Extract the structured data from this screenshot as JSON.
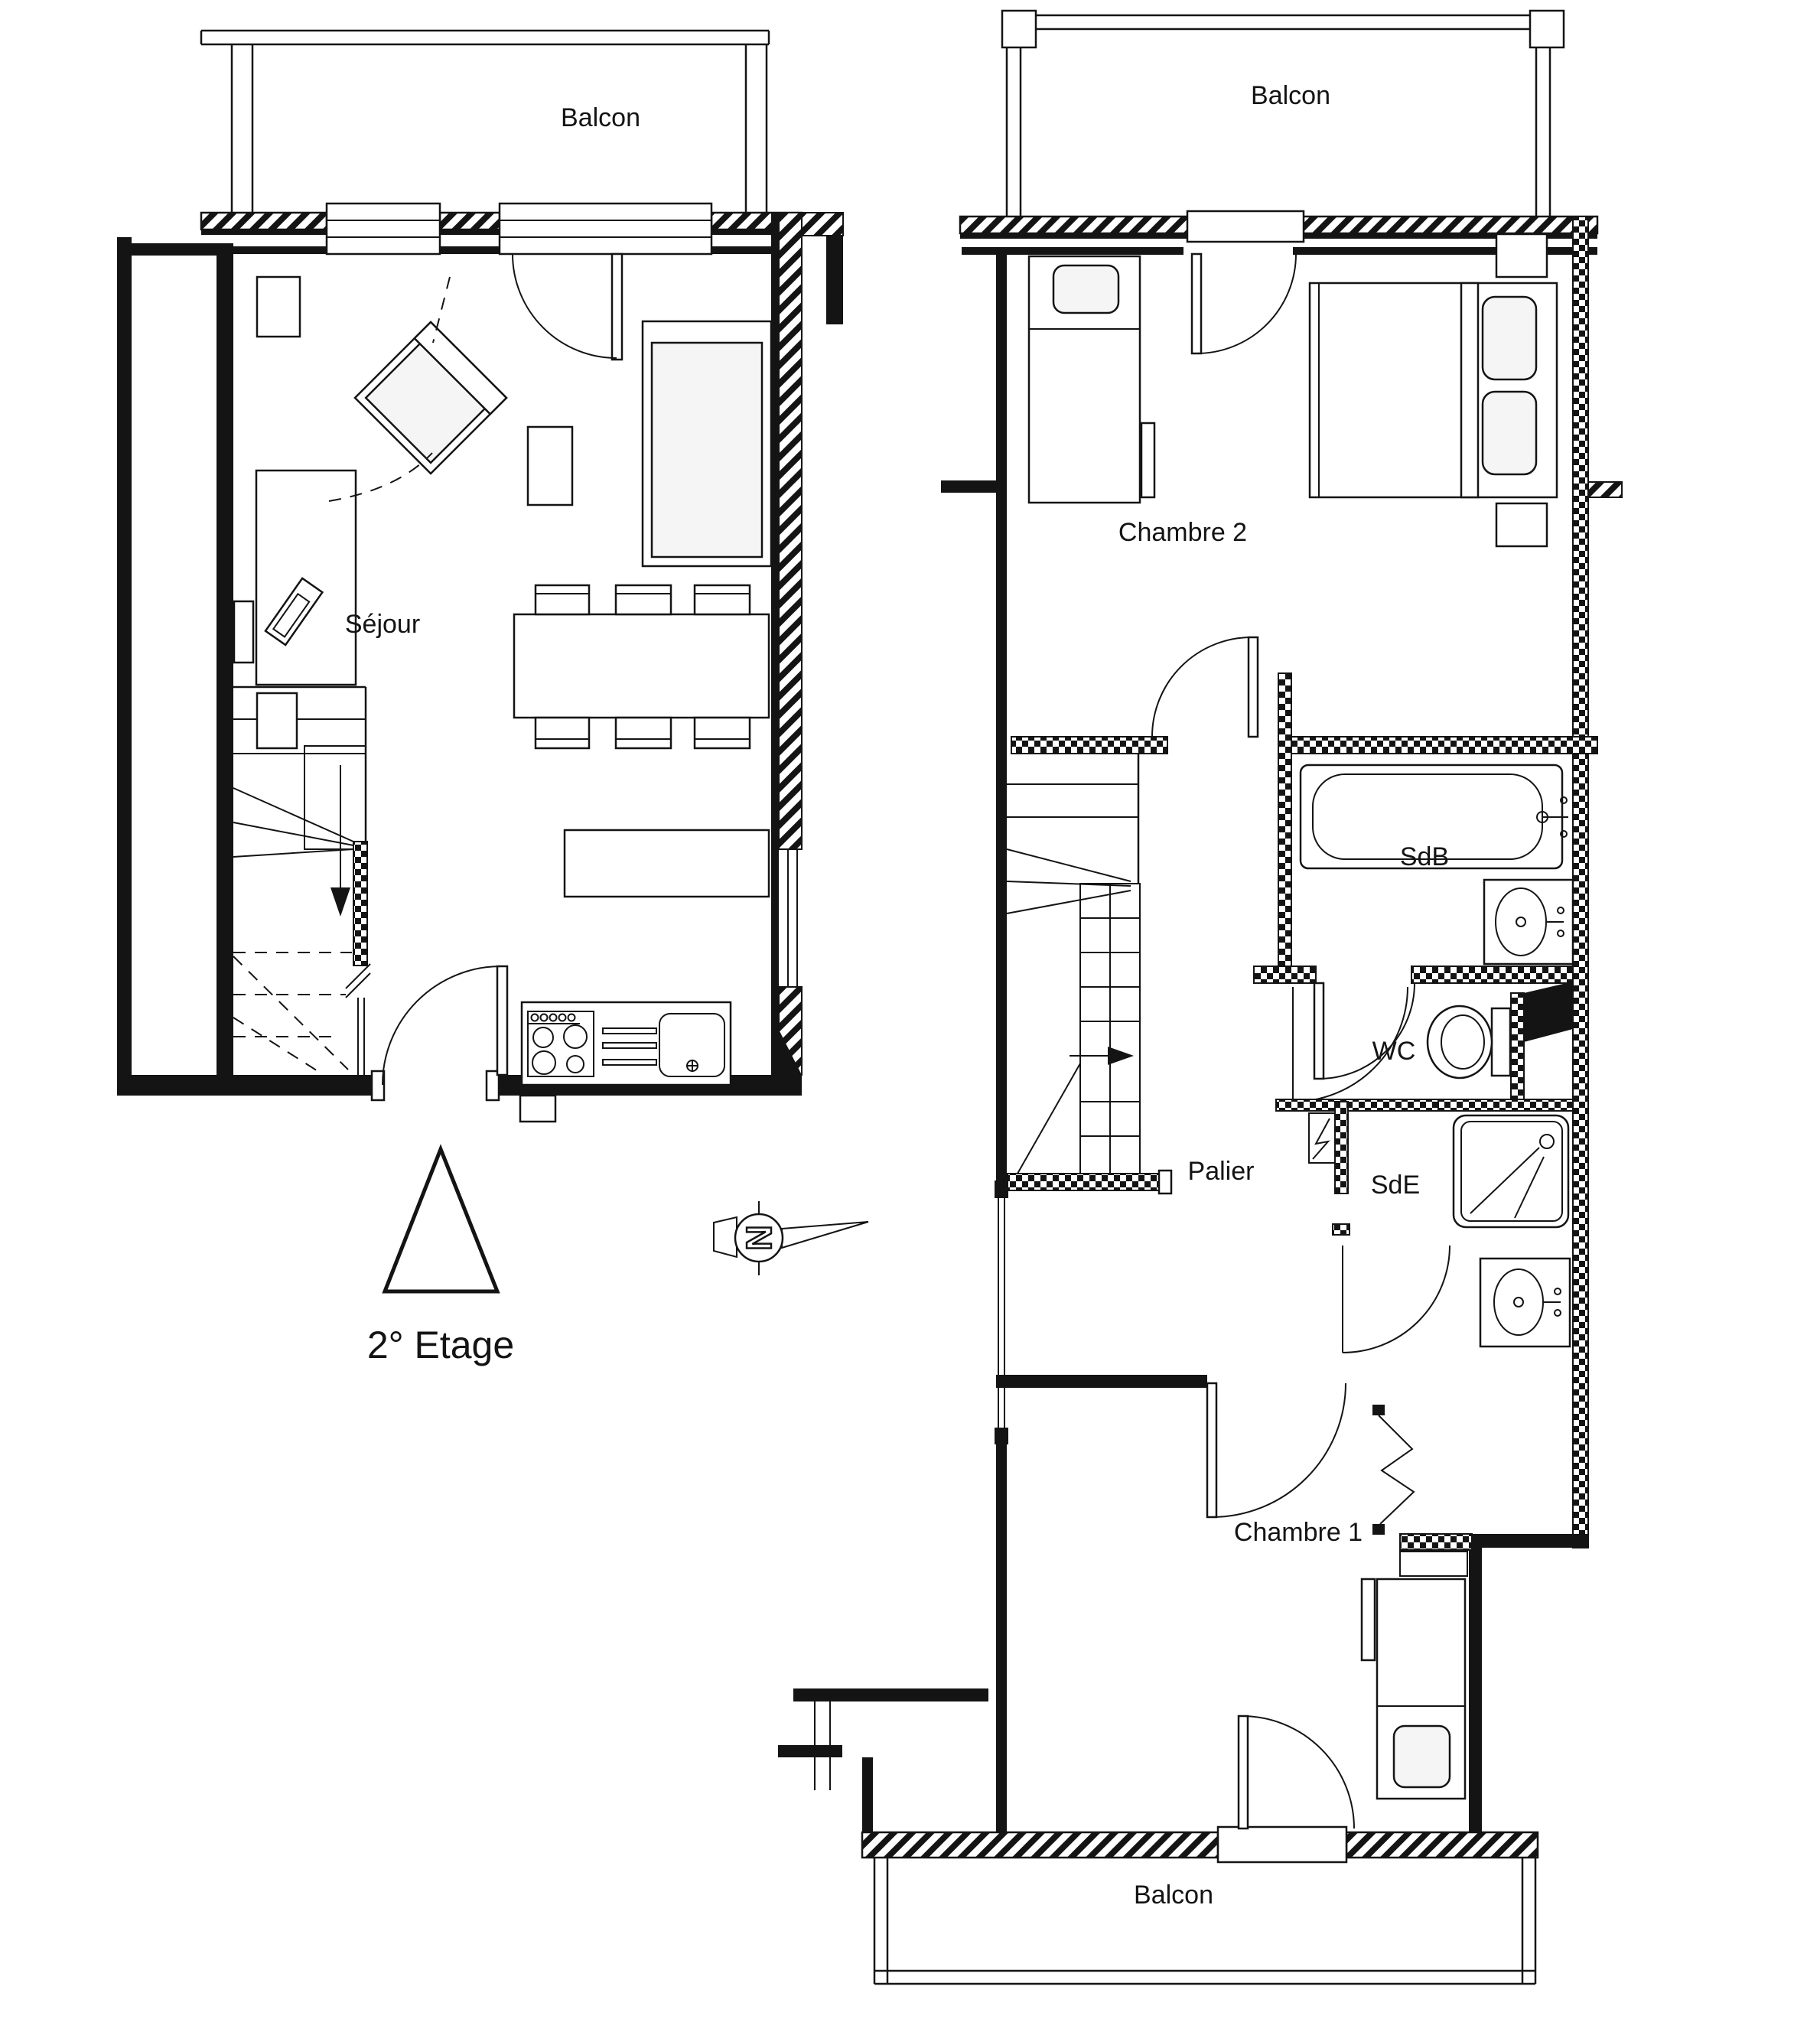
{
  "floor": {
    "label": "2° Etage"
  },
  "compass": {
    "north_letter": "N"
  },
  "left_plan": {
    "balcony": "Balcon",
    "living_room": "Séjour"
  },
  "right_plan": {
    "balcony_top": "Balcon",
    "bedroom2": "Chambre 2",
    "bathroom": "SdB",
    "wc": "WC",
    "landing": "Palier",
    "shower_room": "SdE",
    "bedroom1": "Chambre 1",
    "balcony_bottom": "Balcon"
  },
  "colors": {
    "ink": "#141414",
    "paper": "#ffffff",
    "light_fill": "#f5f5f5"
  }
}
